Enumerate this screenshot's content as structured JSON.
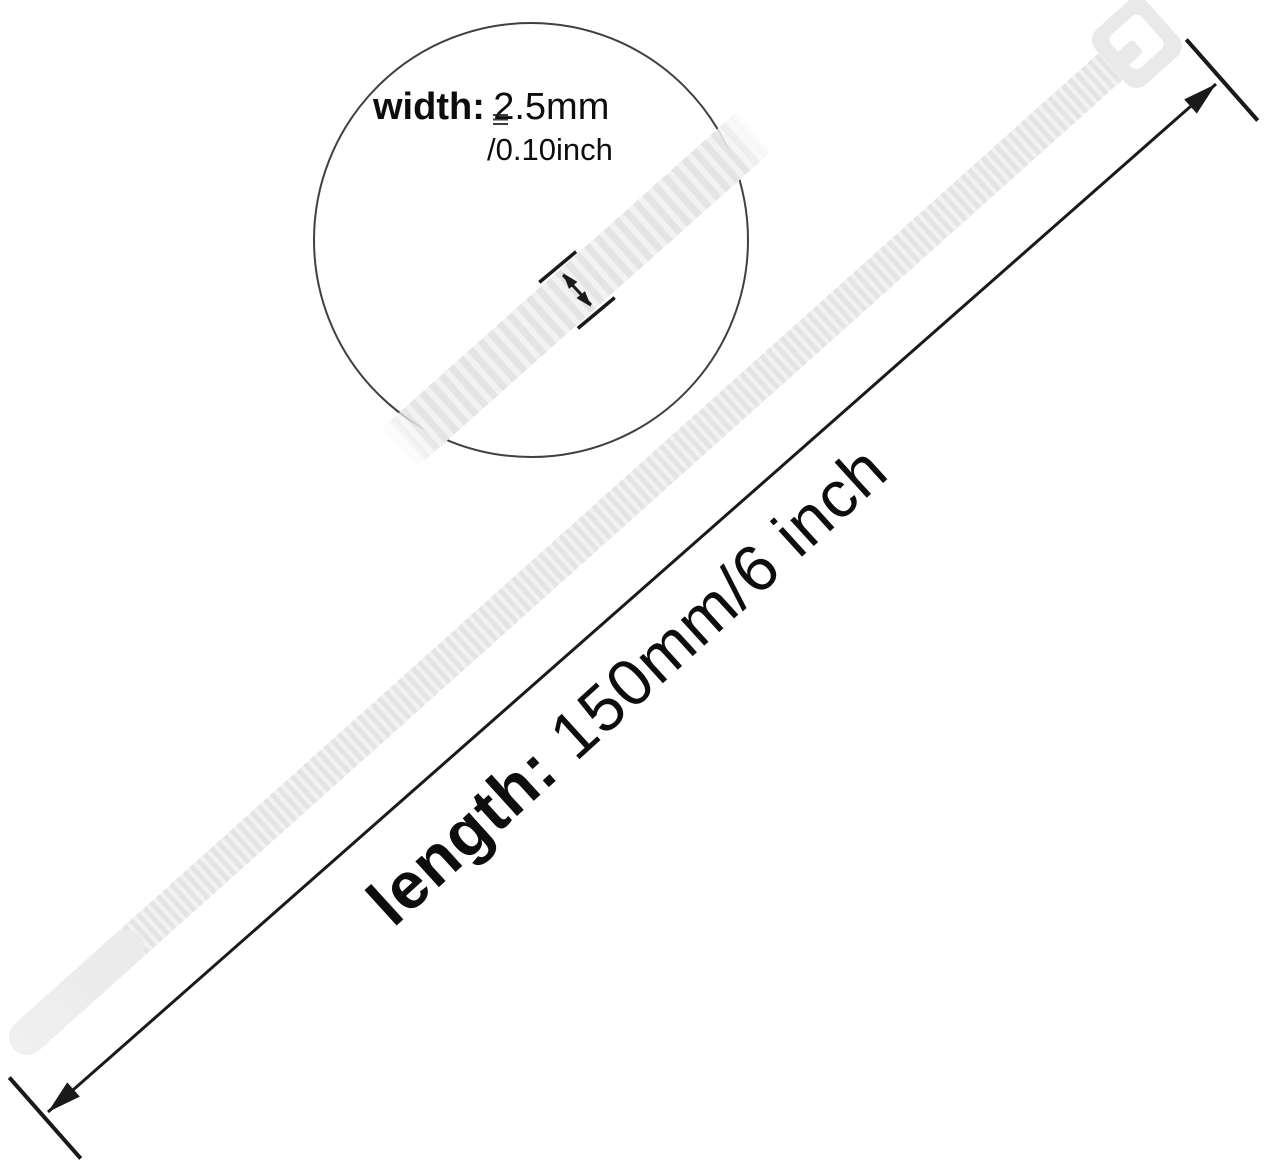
{
  "labels": {
    "width": {
      "term": "width:",
      "value": "2.5mm",
      "secondary": "/0.10inch"
    },
    "length": {
      "term": "length:",
      "value": "150mm/6 inch"
    }
  },
  "colors": {
    "background": "#ffffff",
    "ink": "#1a1a1a",
    "text": "#0d0d0d",
    "circle_stroke": "#404040",
    "strap_base": "#ebebeb",
    "strap_tooth": "#e4e4e4",
    "strap_gap": "#f2f2f2",
    "head": "#e9e9e9",
    "slot": "#ffffff"
  }
}
